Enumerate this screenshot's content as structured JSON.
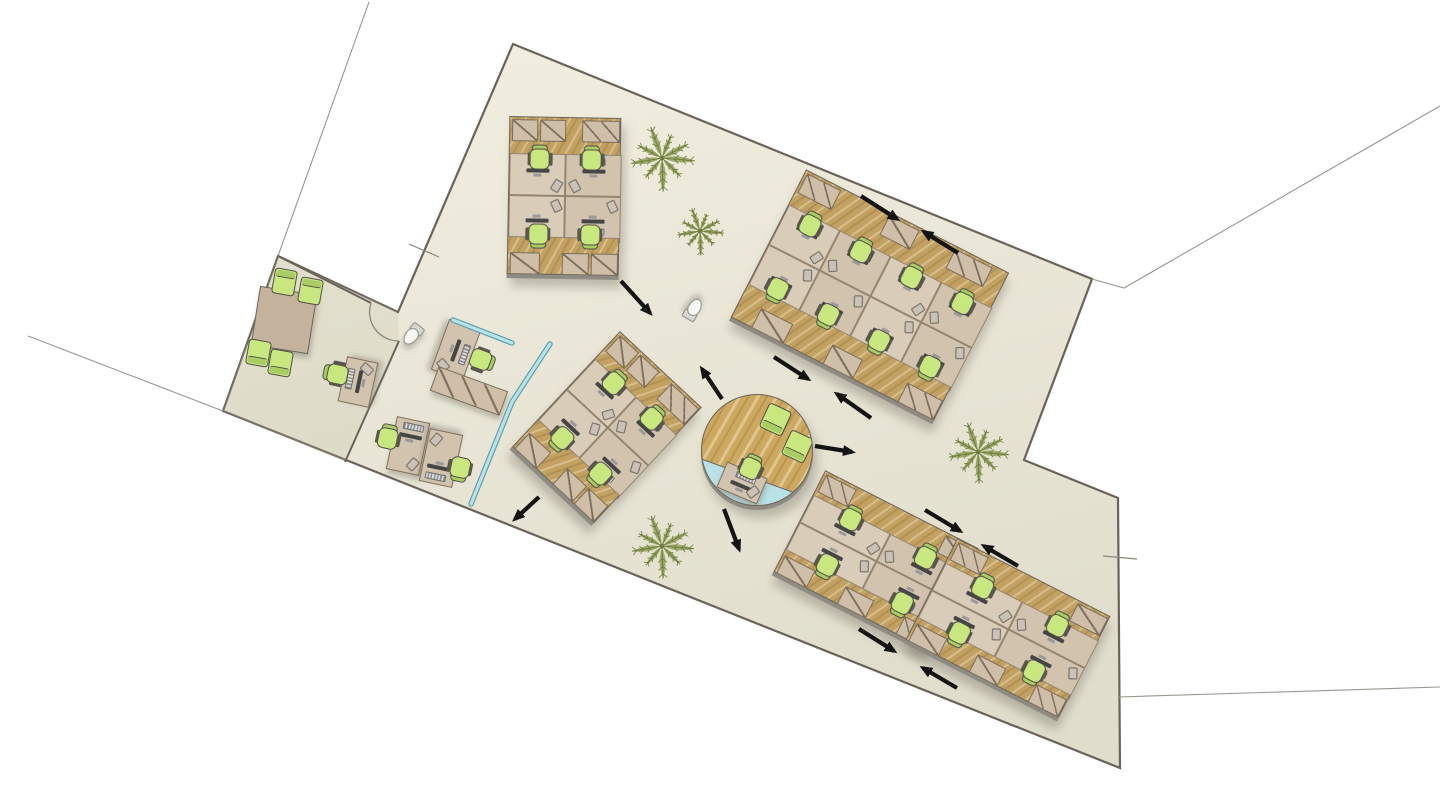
{
  "canvas": {
    "w": 1440,
    "h": 795,
    "bg": "#ffffff"
  },
  "palette": {
    "floor_fill_light": "#f1eee0",
    "floor_fill_dark": "#e0ddcc",
    "wall": "#6b635a",
    "site_line": "#9a968e",
    "wood": "#c2a161",
    "wood_hub": "#cda85f",
    "desk": "#d9ccb9",
    "desk_alt": "#d2c3af",
    "cabinet": "#cfbfa9",
    "cabinet_line": "#7c6e5c",
    "chair_green": "#c9e77f",
    "chair_back": "#a9cc63",
    "chair_dark": "#4f4f49",
    "glass": "#b5e4ea",
    "glass_edge": "#5f9aa6",
    "arrow": "#141414",
    "plant": "#8b9b51",
    "plant_dark": "#6e7e3c",
    "table": "#c5b29d",
    "shadow": "#8e8b83",
    "toilet": "#f7f7f4",
    "toilet_edge": "#8f8d87",
    "annex_tint": "rgba(186,180,155,0.22)",
    "hub_wedge": "#b9e2e6"
  },
  "floor": {
    "outline": [
      [
        513,
        44
      ],
      [
        1092,
        279
      ],
      [
        1024,
        460
      ],
      [
        1118,
        498
      ],
      [
        1120,
        768
      ],
      [
        223,
        411
      ],
      [
        278,
        256
      ],
      [
        398,
        312
      ]
    ],
    "annex": [
      [
        278,
        256
      ],
      [
        398,
        312
      ],
      [
        399,
        341
      ],
      [
        345,
        462
      ],
      [
        223,
        411
      ]
    ]
  },
  "walls": [
    [
      [
        278,
        256
      ],
      [
        371,
        303
      ]
    ],
    [
      [
        399,
        341
      ],
      [
        345,
        462
      ]
    ]
  ],
  "door_arc": "M371,303 A29,29 0 0 0 399,341",
  "site_lines": [
    [
      [
        369,
        2
      ],
      [
        278,
        256
      ]
    ],
    [
      [
        28,
        336
      ],
      [
        223,
        411
      ]
    ],
    [
      [
        1092,
        279
      ],
      [
        1124,
        288
      ],
      [
        1440,
        106
      ]
    ],
    [
      [
        1118,
        697
      ],
      [
        1440,
        687
      ]
    ]
  ],
  "ticks": [
    [
      [
        409,
        244
      ],
      [
        439,
        257
      ]
    ],
    [
      [
        1103,
        556
      ],
      [
        1137,
        559
      ]
    ]
  ],
  "glass": [
    [
      [
        453,
        320
      ],
      [
        512,
        343
      ]
    ],
    [
      [
        550,
        344
      ],
      [
        512,
        402
      ],
      [
        471,
        504
      ]
    ]
  ],
  "pod_types": {
    "p4v": {
      "w": 112,
      "h": 158,
      "strip": 36,
      "band": [
        36,
        120
      ],
      "cols": 2,
      "cabH": 22,
      "cabsTop": [
        [
          2,
          26,
          1
        ],
        [
          30,
          26,
          1
        ],
        [
          72,
          38,
          2
        ]
      ],
      "cabsBot": [
        [
          2,
          30,
          1
        ],
        [
          54,
          27,
          1
        ],
        [
          83,
          27,
          1
        ]
      ],
      "chairsX": [
        30,
        82
      ],
      "chairYT": 40,
      "chairYB": 118
    },
    "p8": {
      "w": 228,
      "h": 166,
      "strip": 38,
      "band": [
        38,
        128
      ],
      "cols": 4,
      "cabH": 22,
      "cabsTop": [
        [
          2,
          38,
          2
        ],
        [
          94,
          34,
          1
        ],
        [
          168,
          42,
          2
        ]
      ],
      "cabsBot": [
        [
          22,
          36,
          1
        ],
        [
          102,
          34,
          1
        ],
        [
          186,
          40,
          2
        ]
      ],
      "chairsX": [
        28,
        85,
        142,
        199
      ],
      "chairYT": 46,
      "chairYB": 120
    },
    "p4h": {
      "w": 172,
      "h": 114,
      "strip": 26,
      "band": [
        26,
        88
      ],
      "cols": 2,
      "cabH": 20,
      "cabsTop": [
        [
          2,
          34,
          2
        ],
        [
          136,
          34,
          1
        ]
      ],
      "cabsBot": [
        [
          2,
          34,
          1
        ],
        [
          70,
          32,
          1
        ],
        [
          136,
          34,
          2
        ]
      ],
      "chairsX": [
        44,
        128
      ],
      "chairYT": 30,
      "chairYB": 84
    }
  },
  "pods": [
    {
      "id": "pod-top-left",
      "type": "p4v",
      "cx": 564,
      "cy": 196,
      "rot": 1
    },
    {
      "id": "pod-middle",
      "type": "p4v",
      "cx": 607,
      "cy": 427,
      "rot": 43
    },
    {
      "id": "pod-right",
      "type": "p8",
      "cx": 870,
      "cy": 295,
      "rot": 27
    },
    {
      "id": "pod-bottom-left",
      "type": "p4h",
      "cx": 876,
      "cy": 560,
      "rot": 27
    },
    {
      "id": "pod-bottom-right",
      "type": "p4h",
      "cx": 1008,
      "cy": 628,
      "rot": 27
    }
  ],
  "hub": {
    "cx": 757,
    "cy": 450,
    "r": 56,
    "desk": {
      "x": 40,
      "y": 88,
      "w": 44,
      "h": 28,
      "rot": 23
    },
    "chair": {
      "x": 49,
      "y": 72,
      "rot": 25
    },
    "lounges": [
      {
        "x": 72,
        "y": 23,
        "rot": 205
      },
      {
        "x": 94,
        "y": 50,
        "rot": 205
      }
    ]
  },
  "meeting_table": {
    "cx": 284,
    "cy": 320,
    "w": 58,
    "h": 60,
    "rot": 9,
    "chairs": [
      {
        "x": 283,
        "y": 281,
        "rot": 10
      },
      {
        "x": 309,
        "y": 290,
        "rot": 10
      },
      {
        "x": 257,
        "y": 352,
        "rot": 190
      },
      {
        "x": 279,
        "y": 362,
        "rot": 190
      }
    ]
  },
  "desks_standalone": [
    {
      "id": "desk-single",
      "cx": 358,
      "cy": 382,
      "w": 46,
      "h": 32,
      "rot": -78,
      "chair": {
        "x": 336,
        "y": 374,
        "rot": -78
      }
    },
    {
      "id": "desk-duo-a",
      "cx": 408,
      "cy": 446,
      "w": 34,
      "h": 54,
      "rot": 12,
      "chair": {
        "x": 388,
        "y": 437,
        "rot": 12
      }
    },
    {
      "id": "desk-duo-b",
      "cx": 441,
      "cy": 458,
      "w": 34,
      "h": 54,
      "rot": 192,
      "chair": {
        "x": 460,
        "y": 469,
        "rot": 192
      }
    },
    {
      "id": "desk-corner",
      "cx": 456,
      "cy": 350,
      "w": 54,
      "h": 34,
      "rot": 110,
      "chair": {
        "x": 482,
        "y": 360,
        "rot": 110
      }
    }
  ],
  "cab_rows": [
    {
      "cx": 469,
      "cy": 391,
      "w": 74,
      "h": 26,
      "rot": 20,
      "cells": 3
    }
  ],
  "toilets": [
    {
      "cx": 412,
      "cy": 334,
      "rot": 38
    },
    {
      "cx": 693,
      "cy": 309,
      "rot": -150
    }
  ],
  "plants": [
    {
      "cx": 662,
      "cy": 158,
      "r": 33
    },
    {
      "cx": 700,
      "cy": 231,
      "r": 24
    },
    {
      "cx": 978,
      "cy": 452,
      "r": 31
    },
    {
      "cx": 662,
      "cy": 546,
      "r": 32
    }
  ],
  "arrows": [
    [
      621,
      281,
      650,
      313
    ],
    [
      861,
      196,
      897,
      219
    ],
    [
      958,
      253,
      924,
      232
    ],
    [
      774,
      357,
      808,
      379
    ],
    [
      871,
      418,
      837,
      394
    ],
    [
      815,
      446,
      852,
      452
    ],
    [
      722,
      399,
      702,
      369
    ],
    [
      539,
      497,
      515,
      519
    ],
    [
      724,
      509,
      739,
      549
    ],
    [
      925,
      510,
      960,
      531
    ],
    [
      1018,
      566,
      984,
      546
    ],
    [
      859,
      629,
      894,
      651
    ],
    [
      957,
      688,
      923,
      668
    ]
  ],
  "stats": {
    "workstations": 24,
    "standalone_desks": 4,
    "hub_desks": 1,
    "meeting_seats": 4,
    "lounge_chairs": 2,
    "plants": 4,
    "toilets": 2,
    "flow_arrows": 13
  }
}
